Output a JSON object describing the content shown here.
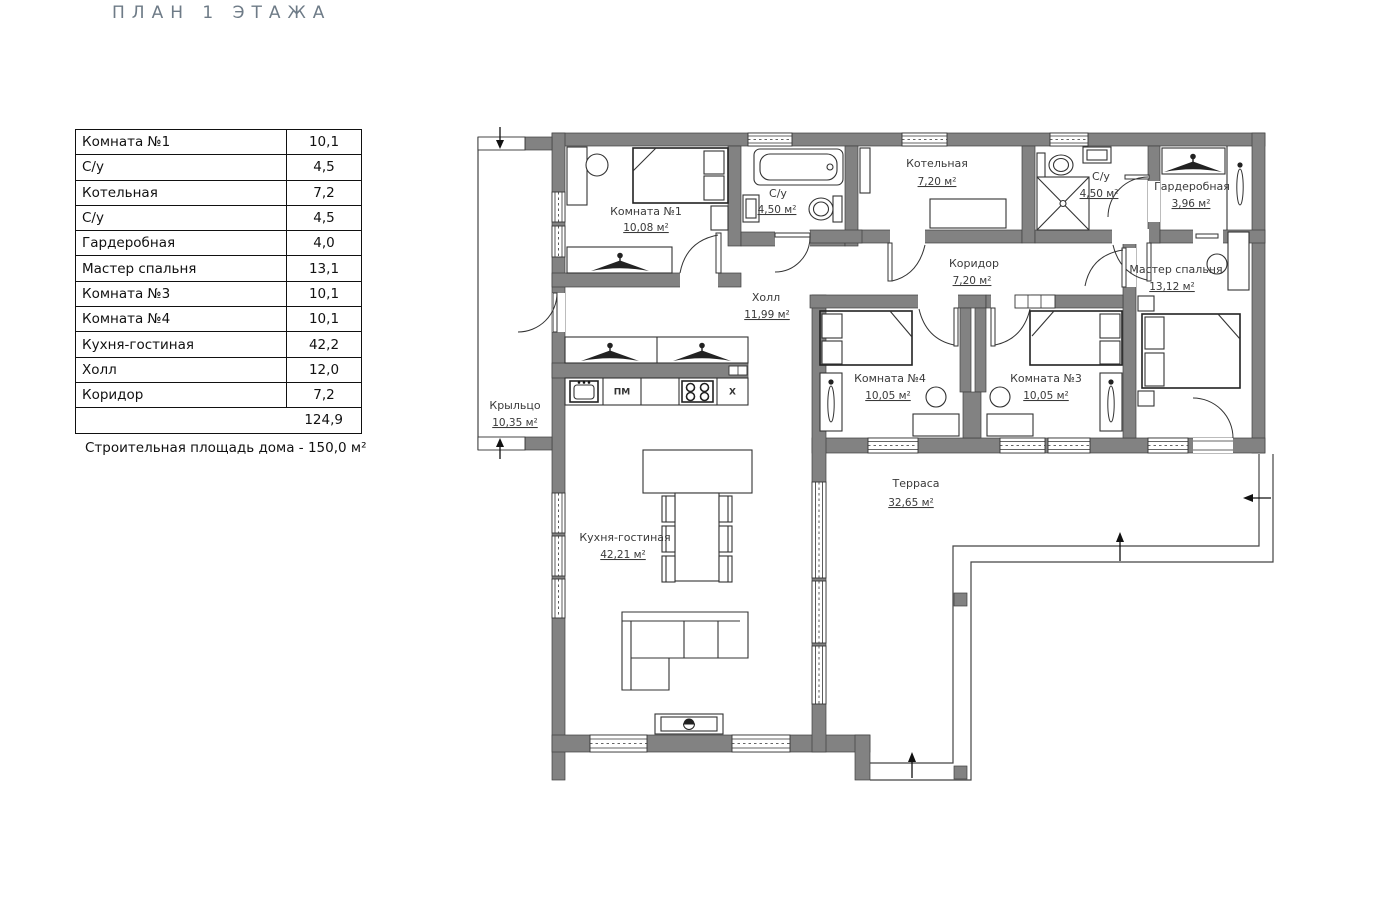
{
  "page_title": "ПЛАН 1 ЭТАЖА",
  "area_table": {
    "rows": [
      {
        "name": "Комната №1",
        "value": "10,1"
      },
      {
        "name": "С/у",
        "value": "4,5"
      },
      {
        "name": "Котельная",
        "value": "7,2"
      },
      {
        "name": "С/у",
        "value": "4,5"
      },
      {
        "name": "Гардеробная",
        "value": "4,0"
      },
      {
        "name": "Мастер спальня",
        "value": "13,1"
      },
      {
        "name": "Комната №3",
        "value": "10,1"
      },
      {
        "name": "Комната №4",
        "value": "10,1"
      },
      {
        "name": "Кухня-гостиная",
        "value": "42,2"
      },
      {
        "name": "Холл",
        "value": "12,0"
      },
      {
        "name": "Коридор",
        "value": "7,2"
      }
    ],
    "total": "124,9"
  },
  "note": "Строительная площадь дома - 150,0 м²",
  "plan": {
    "rooms": [
      {
        "name": "Комната №1",
        "area": "10,08 м²"
      },
      {
        "name": "С/у",
        "area": "4,50 м²"
      },
      {
        "name": "Котельная",
        "area": "7,20 м²"
      },
      {
        "name": "С/у",
        "area": "4,50 м²"
      },
      {
        "name": "Гардеробная",
        "area": "3,96 м²"
      },
      {
        "name": "Коридор",
        "area": "7,20 м²"
      },
      {
        "name": "Мастер спальня",
        "area": "13,12 м²"
      },
      {
        "name": "Холл",
        "area": "11,99 м²"
      },
      {
        "name": "Комната №4",
        "area": "10,05 м²"
      },
      {
        "name": "Комната №3",
        "area": "10,05 м²"
      },
      {
        "name": "Крыльцо",
        "area": "10,35 м²"
      },
      {
        "name": "Кухня-гостиная",
        "area": "42,21 м²"
      },
      {
        "name": "Терраса",
        "area": "32,65 м²"
      }
    ],
    "appliance_labels": {
      "dishwasher": "ПМ",
      "fridge": "Х"
    }
  },
  "colors": {
    "wall": "#828282",
    "line": "#3a3a3a",
    "title": "#6e7b87"
  }
}
